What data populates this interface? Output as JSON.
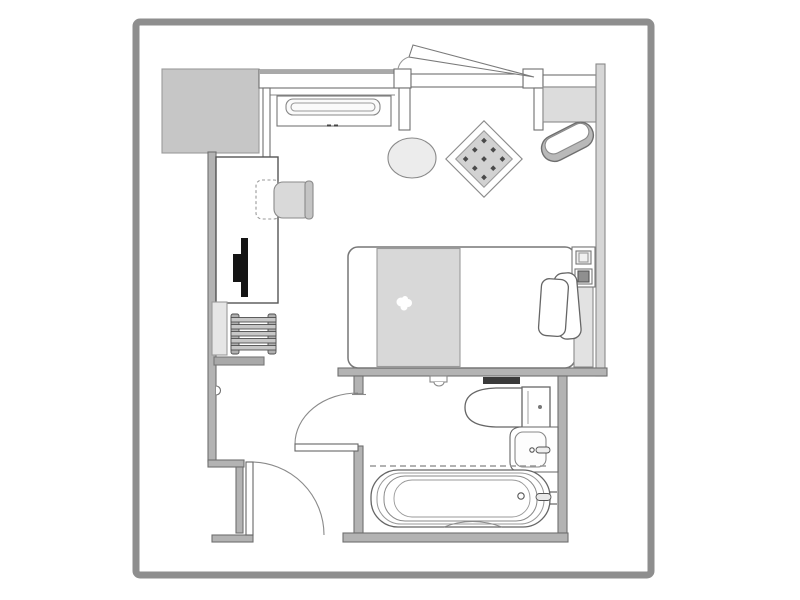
{
  "plan": {
    "kind": "hotel-room-floor-plan",
    "items": {
      "wardrobe": "wardrobe cabinet",
      "top_wall": "exterior wall with window",
      "open_sash": "window sash shown open",
      "console": "console cabinet with cushion",
      "counter": "counter / minibar top",
      "right_wall": "right exterior wall",
      "round_table": "round side table",
      "area_rug": "decorative diamond rug",
      "bench": "ottoman bench",
      "bed": "single bed",
      "duvet": "folded duvet runner",
      "pillow": "pillow",
      "headboard": "headboard panel",
      "bedside_panel": "bedside control panel",
      "desk": "work desk",
      "chair": "desk chair",
      "tv": "television on desk",
      "mirror": "wall mirror panel",
      "luggage_rack": "luggage rack",
      "shelf": "wall shelf",
      "entry_door": "entry door with swing",
      "bath_door": "bathroom door with swing",
      "toilet": "toilet",
      "vanity": "vanity with sink basin",
      "bathtub": "bathtub",
      "curtain": "shower curtain track"
    }
  },
  "palette": {
    "frame": "#8e8e8e",
    "wall": "#b3b3b3",
    "wall_soft": "#a9a9a9",
    "wardrobe": "#c6c6c6",
    "counter": "#dcdcdc",
    "right_wall": "#d6d6d6",
    "duvet": "#d8d8d8",
    "headboard": "#e2e2e2",
    "chair": "#d9d9d9",
    "chair_back": "#c4c4c4",
    "rug": "#d2d2d2",
    "rug_dot": "#4a4a4a",
    "table": "#ececec",
    "tv": "#141414",
    "shelf_dark": "#3a3a3a",
    "rack": "#c7c7c7",
    "rack_rail": "#b0b0b0",
    "panel_dark": "#8f8f8f",
    "mirror": "#e6e6e6",
    "bench": "#b9b9b9",
    "paper": "#ffffff"
  }
}
